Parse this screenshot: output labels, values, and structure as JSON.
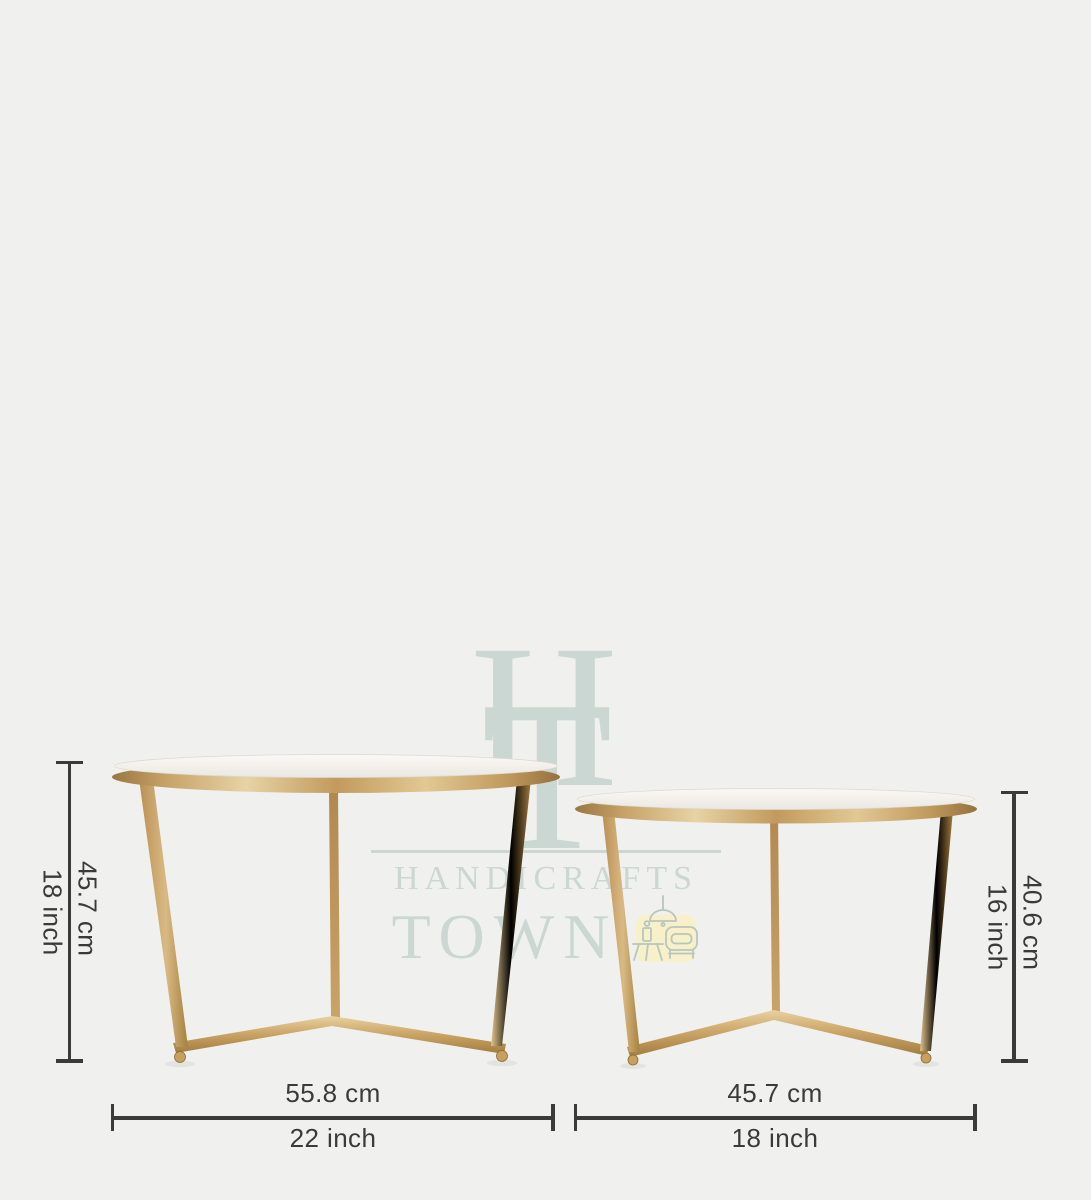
{
  "watermark": {
    "monogram": {
      "letter_h": "H",
      "letter_t": "T"
    },
    "brand_line1": "HANDICRAFTS",
    "brand_line2": "TOWN",
    "icon": "furniture-scene-icon"
  },
  "dimensions": {
    "large_table": {
      "height_cm": "45.7 cm",
      "height_inch": "18 inch",
      "diameter_cm": "55.8 cm",
      "diameter_inch": "22 inch"
    },
    "small_table": {
      "height_cm": "40.6 cm",
      "height_inch": "16 inch",
      "diameter_cm": "45.7 cm",
      "diameter_inch": "18 inch"
    }
  },
  "colors": {
    "background": "#f0f1ef",
    "dimension_line": "#3a3a3a",
    "watermark": "#cbd7d2",
    "watermark_icon_bg": "#f7f0c9",
    "gold": "#c49b5e",
    "marble": "#f8f6f2"
  }
}
